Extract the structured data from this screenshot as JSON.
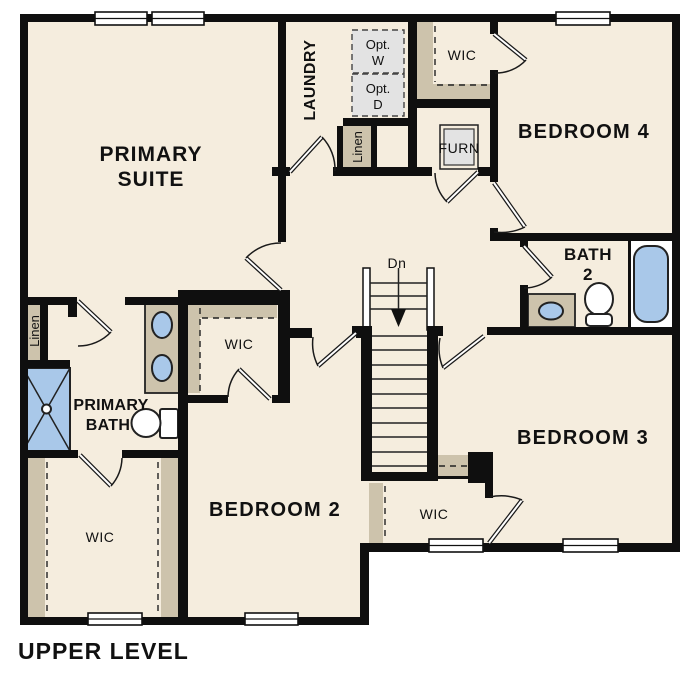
{
  "page_title": "UPPER LEVEL",
  "colors": {
    "background": "#ffffff",
    "floor": "#f5edde",
    "wall": "#0f0f0f",
    "casework_tan": "#cdc3ac",
    "fixture_blue": "#a9c8e9",
    "appliance_gray": "#e3e3e3",
    "text": "#111111"
  },
  "rooms": {
    "primary_suite": {
      "name_line1": "PRIMARY",
      "name_line2": "SUITE"
    },
    "primary_bath": {
      "name_line1": "PRIMARY",
      "name_line2": "BATH",
      "closet": "WIC",
      "linen": "Linen"
    },
    "laundry": {
      "name": "LAUNDRY",
      "opt_washer_line1": "Opt.",
      "opt_washer_line2": "W",
      "opt_dryer_line1": "Opt.",
      "opt_dryer_line2": "D",
      "linen": "Linen"
    },
    "bedroom2": {
      "name": "BEDROOM 2",
      "closet": "WIC"
    },
    "bedroom3": {
      "name": "BEDROOM 3",
      "closet": "WIC"
    },
    "bedroom4": {
      "name": "BEDROOM 4",
      "closet": "WIC"
    },
    "bath2": {
      "name_line1": "BATH",
      "name_line2": "2"
    },
    "utility": {
      "furnace": "FURN"
    }
  },
  "stairs": {
    "down_label": "Dn"
  }
}
